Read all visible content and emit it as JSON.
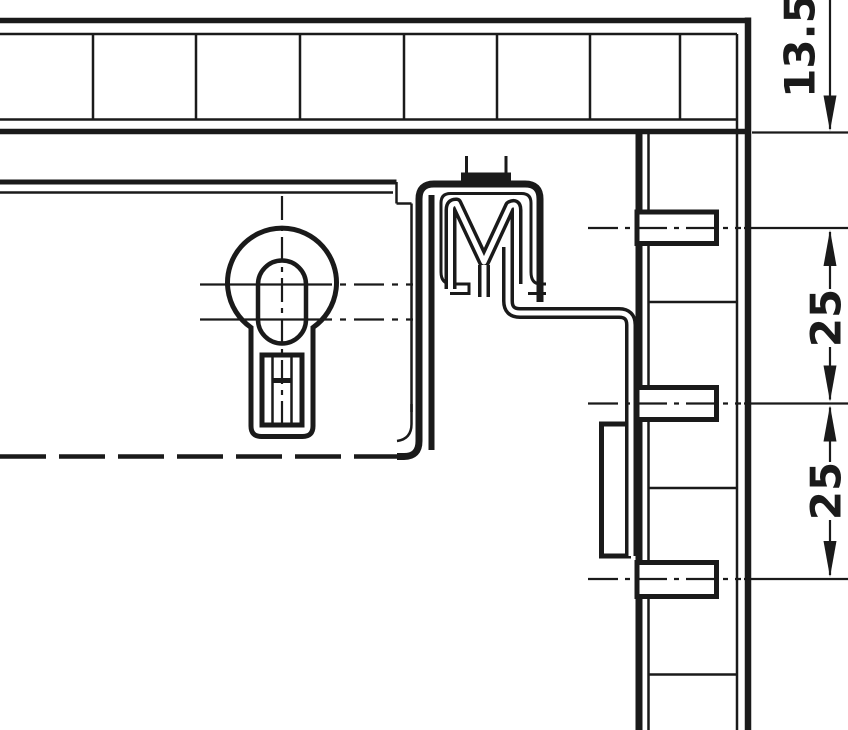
{
  "drawing": {
    "title": "cabinet-hanger-mounting-section",
    "background": "#ffffff",
    "line_color": "#1a1a1a",
    "dimensions": {
      "offset_top": "13.5",
      "pitch_upper": "25",
      "pitch_lower": "25"
    },
    "parts": {
      "top_panel": "sectioned horizontal panel",
      "wall_panel": "vertical system-hole panel with three pegs",
      "hanger": "cabinet suspension bracket with M-profile rail",
      "keyhole": "keyhole mounting slot"
    }
  }
}
